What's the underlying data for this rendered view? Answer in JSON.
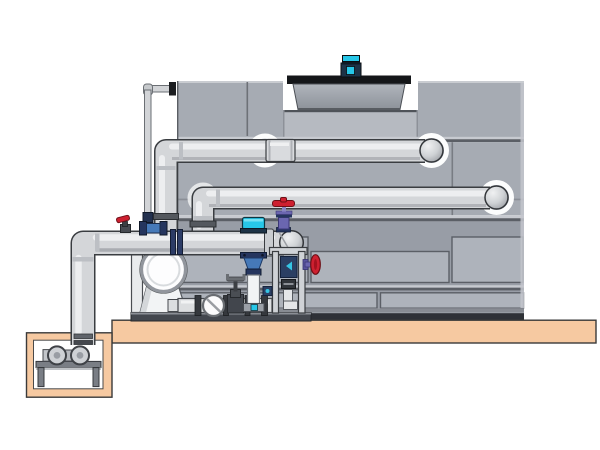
{
  "scene": {
    "type": "technical-illustration",
    "subject": "closed-circuit cooling tower with fan motor, external piping, inline pump skid and sump-pit pump on a concrete pad",
    "background": "#ffffff"
  },
  "colors": {
    "tank_body": "#a6abb3",
    "tank_panel": "#aeb3bb",
    "brick_bg": "#989da6",
    "seam_dark": "#5b5f66",
    "seam_light": "#c7cad0",
    "base_strip": "#888c93",
    "base_dark": "#2e3136",
    "cowl_flange": "#141619",
    "pipe_fill": "#d4d6d9",
    "pipe_outline": "#3a3d41",
    "pipe_highlight": "#f0f1f2",
    "ring_white": "#fcfdfd",
    "motor_cyan": "#27c7e8",
    "navy": "#1d3347",
    "flange_navy": "#25355e",
    "pump_blue": "#4679b8",
    "valve_red": "#ce2030",
    "valve_purple": "#6b66b0",
    "metal_dark": "#43474e",
    "metal_mid": "#6e727a",
    "metal_light": "#cfd2d6",
    "pad_tan": "#f6c9a1",
    "pit_white": "#ffffff",
    "pump_white": "#f2f4f5"
  },
  "components": [
    "cooling-tower-casing",
    "fan-cowl",
    "fan-motor",
    "upper-supply-pipe",
    "middle-return-pipe",
    "suction-header-pipe",
    "riser-pipe",
    "overflow-pipe",
    "escutcheon-rings",
    "inline-vertical-pump",
    "pump-volute",
    "pressure-gauge",
    "gate-valve",
    "globe-valve-red-purple",
    "red-handwheel-valve",
    "equipment-frame-column",
    "skid-base",
    "concrete-pad",
    "sump-pit",
    "pit-pump"
  ]
}
